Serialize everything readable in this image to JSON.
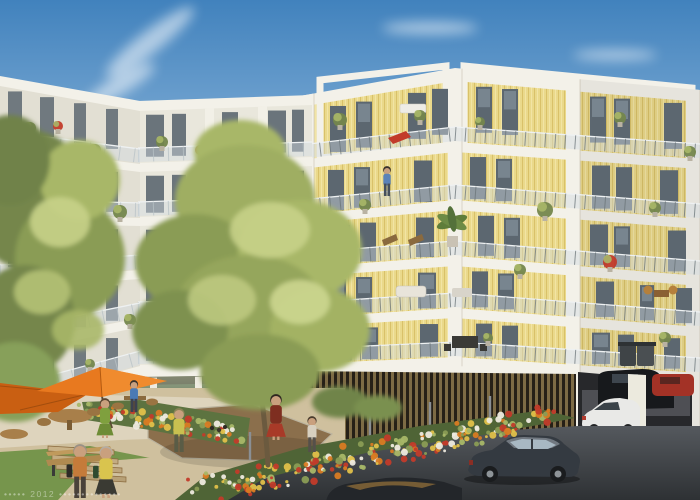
{
  "image": {
    "kind": "architectural rendering",
    "subject": "residential apartment complex with landscaped courtyard and street parking",
    "width": 700,
    "height": 500
  },
  "watermark": {
    "text": "•••••  2012  ••••••••••••••"
  },
  "palette": {
    "sky_top": "#4182bd",
    "sky_mid": "#9cc0e0",
    "sky_low": "#e6eff6",
    "slab_white": "#f3f1e9",
    "facade_yellow": "#ead98b",
    "facade_grain_dark": "#d9c169",
    "facade_grain_light": "#f2e4a4",
    "white_wall": "#e9e7dc",
    "white_wall_shade": "#e2dfd3",
    "window_dark": "#5c6770",
    "window_light": "#93a4ae",
    "glass_rail": "#d2dce2",
    "rail_metal": "#6a7478",
    "rail_metal_light": "#b8c2c6",
    "storefront_deep": "#46523f",
    "slat_wood": "#7d6b45",
    "slat_dark": "#262017",
    "asphalt_far": "#55595e",
    "asphalt_near": "#2e3134",
    "terrace": "#ded4bd",
    "path": "#cfc09e",
    "mulch": "#8b6f4c",
    "grass": "#76954c",
    "grass_dark": "#5d7b3c",
    "foliage_dark": "#74864c",
    "foliage_mid": "#8a9c55",
    "foliage_light": "#a8b768",
    "foliage_sun": "#c6d188",
    "flower_red": "#c23b2a",
    "flower_orange": "#d97b23",
    "flower_yellow": "#e0c04a",
    "umbrella": "#e8791f",
    "umbrella_shade": "#c95f12",
    "trunk": "#6b5a3f",
    "car_dark": "#343a41",
    "car_white": "#e9e9e7",
    "car_red": "#a33226",
    "skin": "#c9a07e"
  },
  "scene": {
    "buildings": [
      {
        "id": "left-white-building",
        "visible_floors": 6,
        "facade": "white render with continuous balconies, glass railings, balcony plants, glazed ground floor"
      },
      {
        "id": "right-timber-building",
        "visible_floors": 6,
        "facade": "vertical timber cladding in white concrete frames, recessed balconies, timber slat screen and open carport at street level"
      }
    ],
    "courtyard": [
      "orange parasols",
      "wooden tables and chairs",
      "flower beds",
      "boules court with petanque balls",
      "large trees",
      "lawn and footpath",
      "terrace steps",
      "wooden bench"
    ],
    "street": [
      "asphalt roadway",
      "parked dark sedan",
      "white hatchback in carport",
      "dark car in carport",
      "red car in carport",
      "flowering hedge with fence posts",
      "waste bins"
    ],
    "people": [
      "elderly couple walking",
      "woman in green dress",
      "man in blue shirt at table",
      "man playing petanque",
      "woman in red dress",
      "child",
      "resident on balcony"
    ]
  }
}
